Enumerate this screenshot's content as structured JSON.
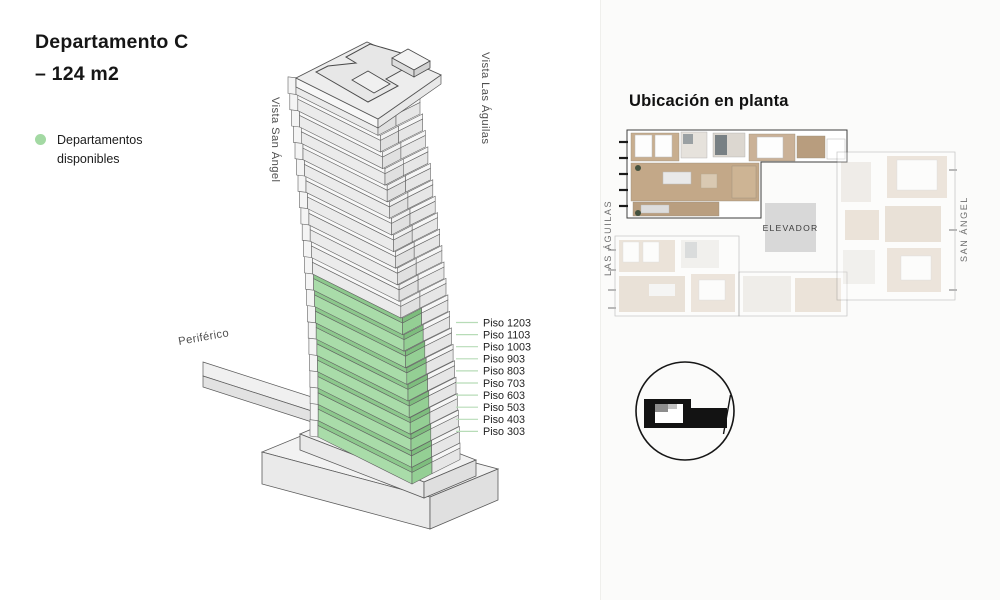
{
  "title": {
    "line1": "Departamento C",
    "line2": "– 124 m2"
  },
  "legend": {
    "dot_color": "#a3d9a3",
    "line1": "Departamentos",
    "line2": "disponibles"
  },
  "building": {
    "street_left": "Vista San Ángel",
    "street_right": "Vista Las Águilas",
    "street_front": "Periférico",
    "highlight_color": "#a9dca9",
    "floors_available": [
      "Piso 1203",
      "Piso 1103",
      "Piso 1003",
      "Piso 903",
      "Piso 803",
      "Piso 703",
      "Piso 603",
      "Piso 503",
      "Piso 403",
      "Piso 303"
    ]
  },
  "plan": {
    "heading": "Ubicación en planta",
    "elevator_label": "ELEVADOR",
    "street_left": "LAS ÁGUILAS",
    "street_right": "SAN ÁNGEL"
  }
}
